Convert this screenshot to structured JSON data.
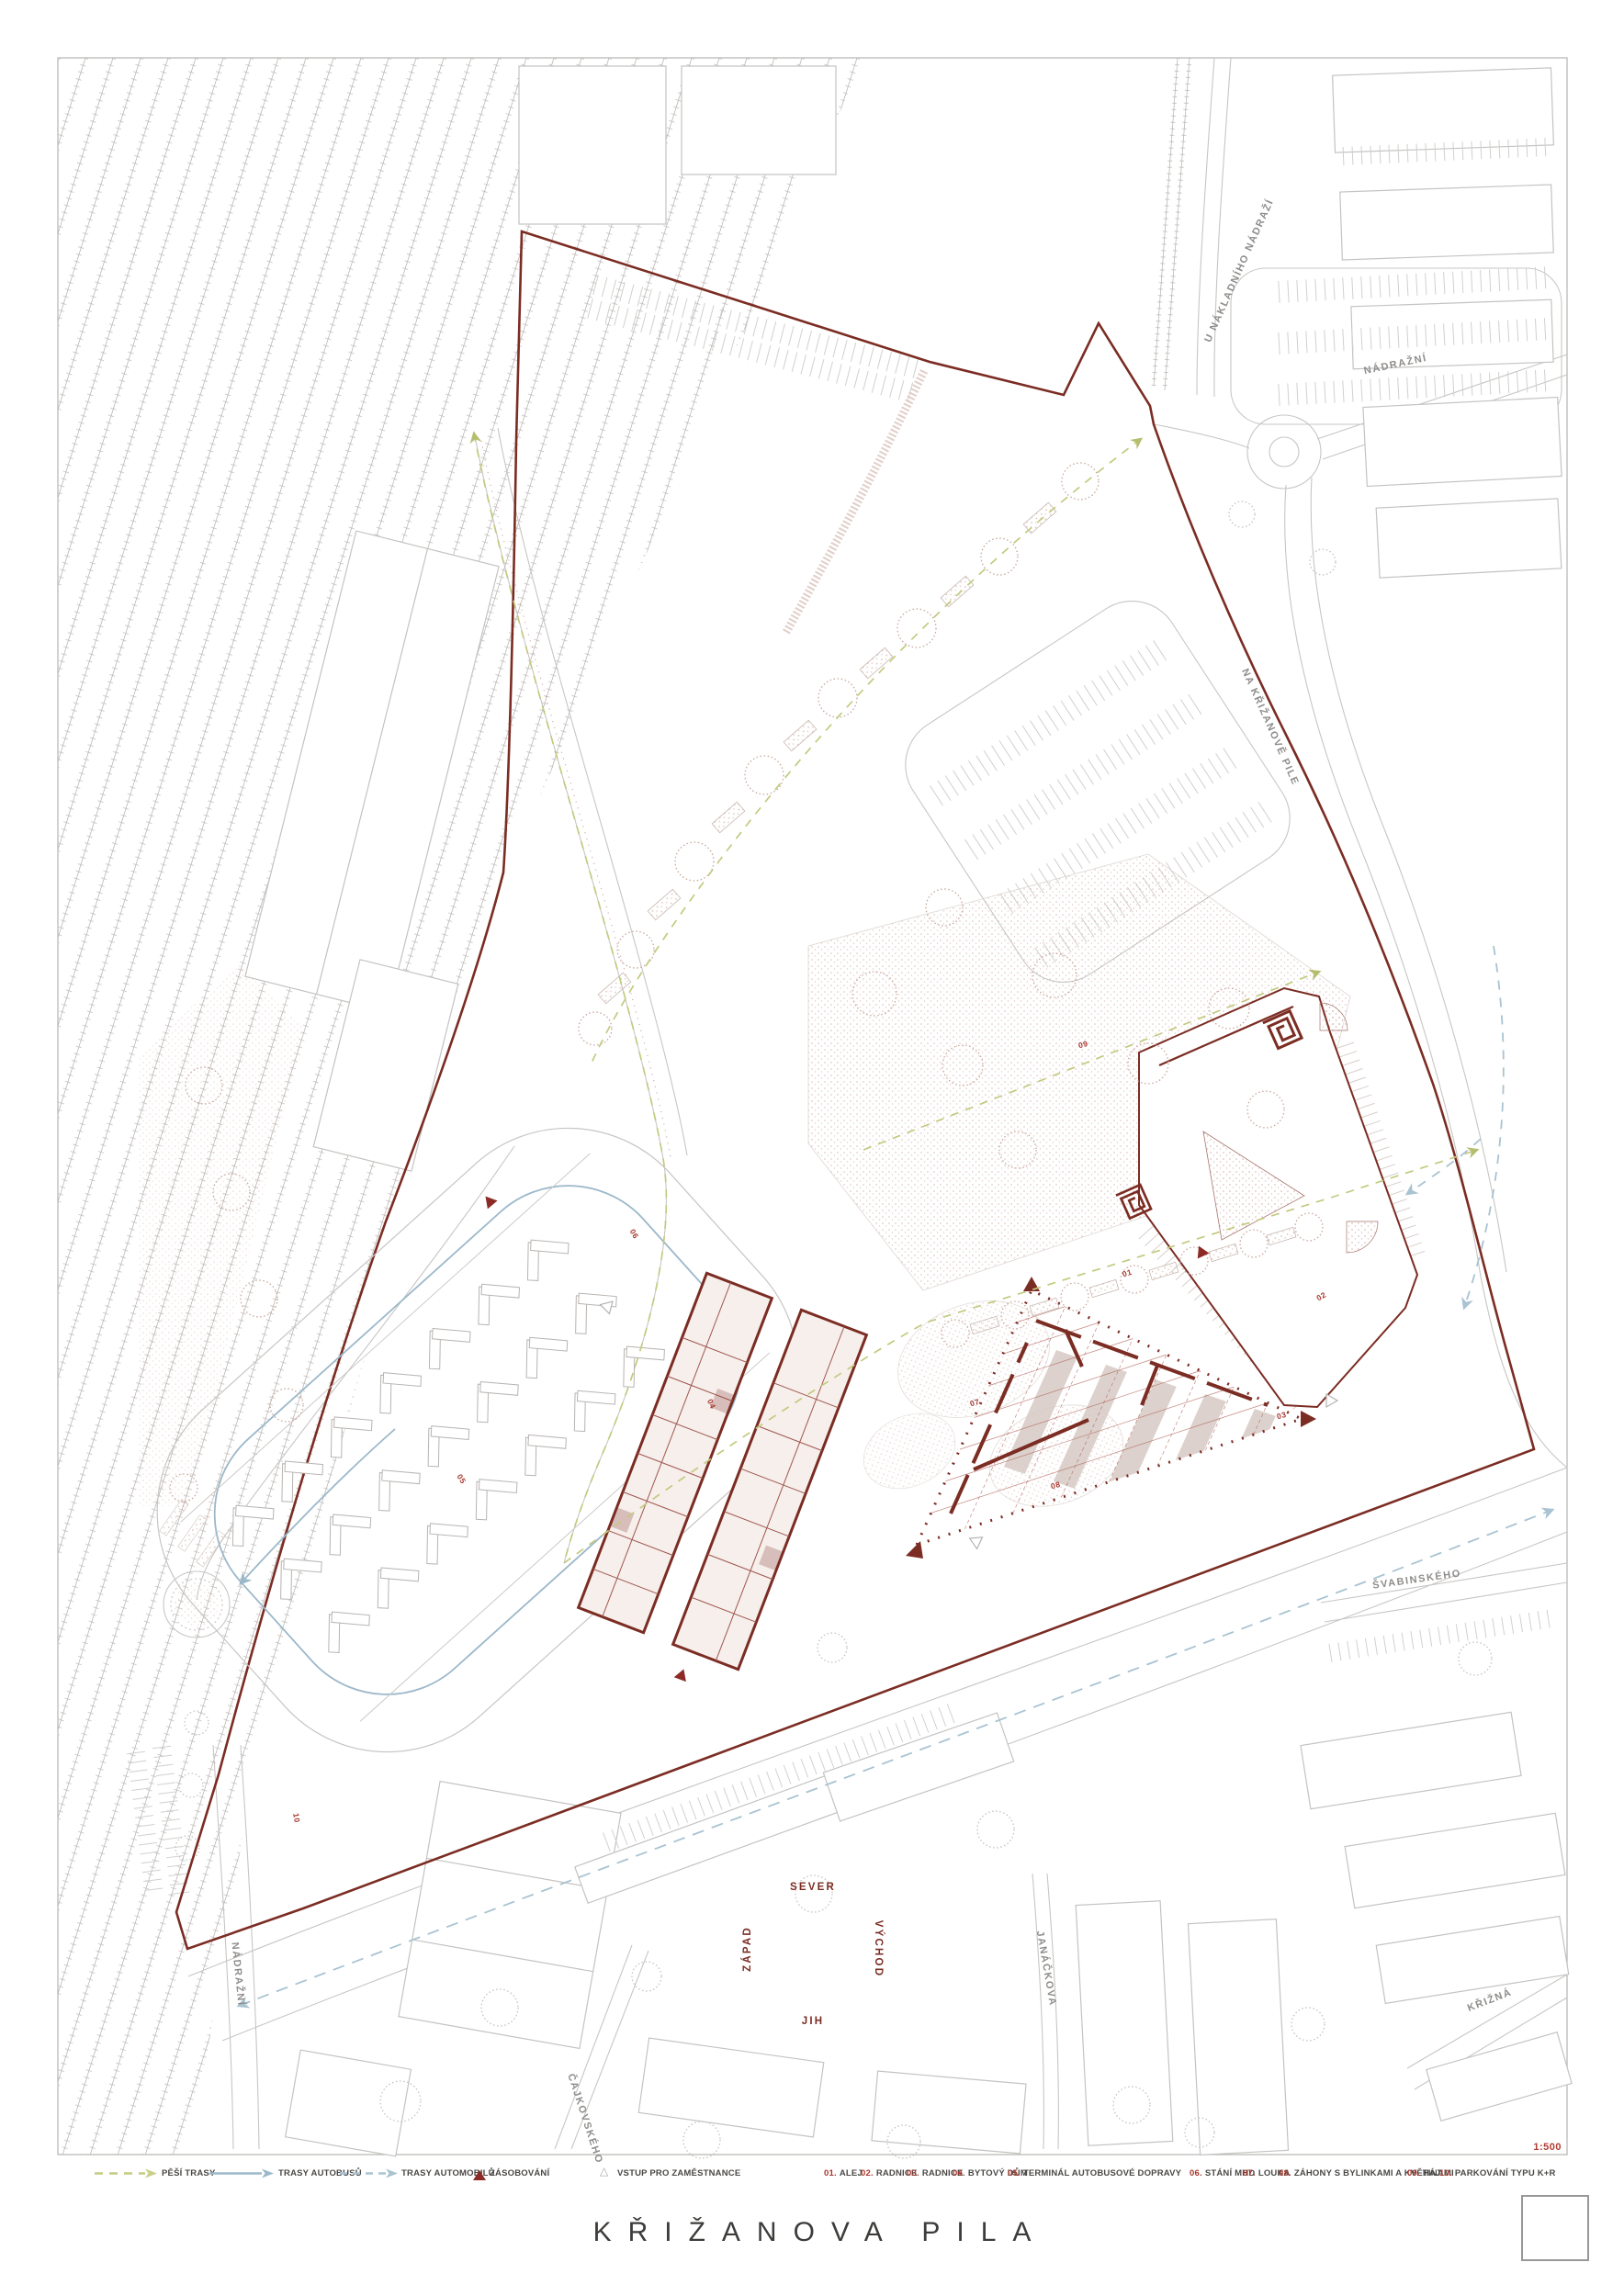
{
  "title": "KŘIŽANOVA PILA",
  "scale": "1:500",
  "colors": {
    "site_red": "#7b2c23",
    "accent_red": "#a8382e",
    "route_green": "#c3ca7f",
    "route_blue": "#9cb8ca",
    "route_blue_dashed": "#a9c3d2",
    "road_gray": "#c8c6c4",
    "text_gray": "#4a4846"
  },
  "legend": {
    "routes": [
      {
        "label": "PĚŠÍ TRASY",
        "style": "dashed-green"
      },
      {
        "label": "TRASY AUTOBUSŮ",
        "style": "solid-blue"
      },
      {
        "label": "TRASY AUTOMOBILŮ",
        "style": "dashed-blue"
      },
      {
        "label": "ZÁSOBOVÁNÍ",
        "style": "red-triangle"
      },
      {
        "label": "VSTUP PRO ZAMĚSTNANCE",
        "style": "outline-triangle"
      }
    ],
    "items": [
      {
        "num": "01.",
        "label": "ALEJ"
      },
      {
        "num": "02.",
        "label": "RADNICE"
      },
      {
        "num": "03.",
        "label": "RADNICE"
      },
      {
        "num": "04.",
        "label": "BYTOVÝ DŮM"
      },
      {
        "num": "05.",
        "label": "TERMINÁL AUTOBUSOVÉ DOPRAVY"
      },
      {
        "num": "06.",
        "label": "STÁNÍ MHD"
      },
      {
        "num": "07.",
        "label": "LOUKA"
      },
      {
        "num": "08.",
        "label": "ZÁHONY S BYLINKAMI A KVĚTINAMI"
      },
      {
        "num": "09.",
        "label": "HÁJ"
      },
      {
        "num": "10.",
        "label": "PARKOVÁNÍ TYPU K+R"
      }
    ]
  },
  "streets": [
    {
      "name": "U NÁKLADNÍHO NÁDRAŽÍ"
    },
    {
      "name": "NÁDRAŽNÍ"
    },
    {
      "name": "NA KŘIŽANOVĚ PILE"
    },
    {
      "name": "ŠVABINSKÉHO"
    },
    {
      "name": "KŘIŽNÁ"
    },
    {
      "name": "JANÁČKOVA"
    },
    {
      "name": "ČAJKOVSKÉHO"
    },
    {
      "name": "NÁDRAŽNÍ"
    }
  ],
  "compass": {
    "north": "SEVER",
    "south": "JIH",
    "west": "ZÁPAD",
    "east": "VÝCHOD"
  },
  "plan_labels": [
    "01",
    "02",
    "03",
    "04",
    "05",
    "06",
    "07",
    "08",
    "09",
    "10"
  ]
}
